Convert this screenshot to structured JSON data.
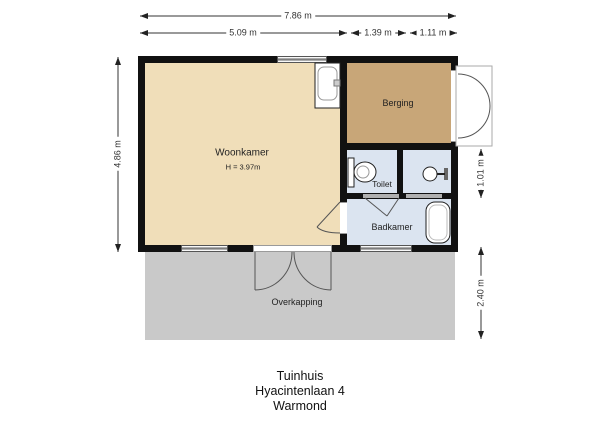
{
  "footer": {
    "building": "Tuinhuis",
    "address": "Hyacintenlaan 4",
    "city": "Warmond"
  },
  "dimensions": {
    "top_total": "7.86 m",
    "top_woonkamer": "5.09 m",
    "top_toilet": "1.39 m",
    "top_shower": "1.11 m",
    "left_building": "4.86 m",
    "right_toilet_row": "1.01 m",
    "right_overkapping": "2.40 m"
  },
  "rooms": {
    "woonkamer": {
      "name": "Woonkamer",
      "ceiling_height": "H = 3.97m",
      "color": "#f0deb9"
    },
    "berging": {
      "name": "Berging",
      "color": "#c8a678"
    },
    "toilet": {
      "name": "Toilet",
      "color": "#dbe4f0"
    },
    "badkamer": {
      "name": "Badkamer",
      "color": "#dbe4f0"
    },
    "overkapping": {
      "name": "Overkapping",
      "color": "#c9c9c9"
    }
  },
  "icons": {
    "sink": "sink-icon",
    "toilet": "toilet-icon",
    "shower": "shower-icon",
    "bathtub": "bathtub-icon"
  },
  "colors": {
    "walls": "#111111",
    "dimension_lines": "#333333",
    "door_swings": "#555555",
    "background": "#ffffff"
  }
}
